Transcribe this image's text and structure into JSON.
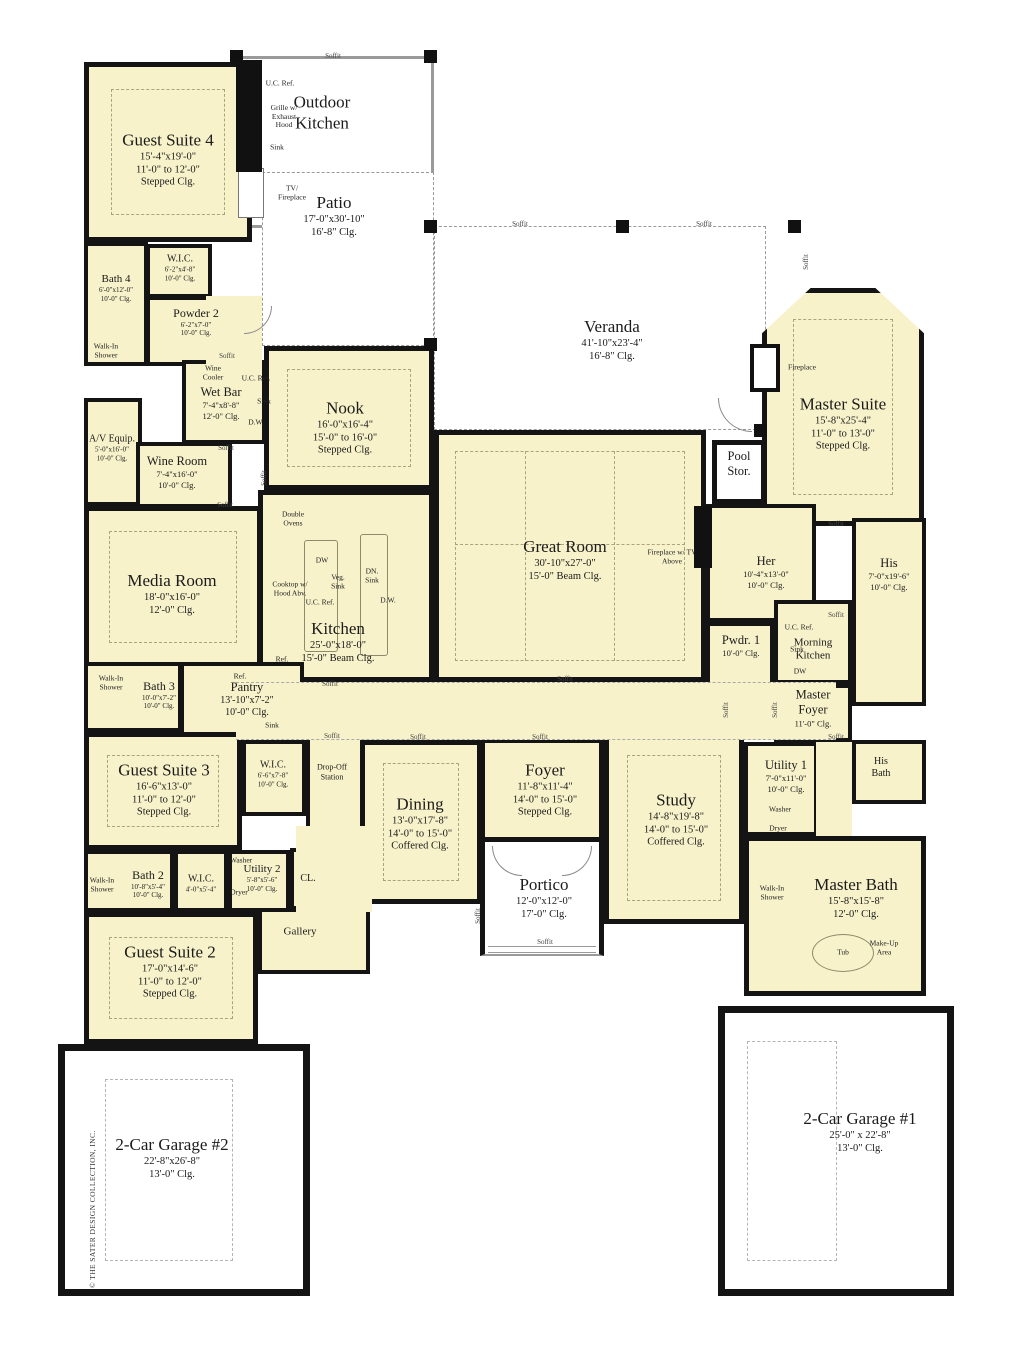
{
  "copyright": "© THE SATER DESIGN COLLECTION, INC.",
  "colors": {
    "room_fill": "#F7F2CA",
    "wall": "#141414",
    "outdoor": "#FFFFFF"
  },
  "rooms": {
    "guest_suite_4": {
      "name": "Guest Suite 4",
      "dim": "15'-4\"x19'-0\"",
      "clg1": "11'-0\" to 12'-0\"",
      "clg2": "Stepped Clg."
    },
    "bath_4": {
      "name": "Bath 4",
      "dim": "6'-0\"x12'-0\"",
      "clg1": "10'-0\" Clg."
    },
    "wic_guest_4": {
      "name": "W.I.C.",
      "dim": "6'-2\"x4'-8\"",
      "clg1": "10'-0\" Clg."
    },
    "powder_2": {
      "name": "Powder 2",
      "dim": "6'-2\"x7'-0\"",
      "clg1": "10'-0\" Clg."
    },
    "outdoor_kitchen": {
      "name": "Outdoor Kitchen"
    },
    "patio": {
      "name": "Patio",
      "dim": "17'-0\"x30'-10\"",
      "clg1": "16'-8\" Clg."
    },
    "veranda": {
      "name": "Veranda",
      "dim": "41'-10\"x23'-4\"",
      "clg1": "16'-8\" Clg."
    },
    "master_suite": {
      "name": "Master Suite",
      "dim": "15'-8\"x25'-4\"",
      "clg1": "11'-0\" to 13'-0\"",
      "clg2": "Stepped Clg."
    },
    "wet_bar": {
      "name": "Wet Bar",
      "dim": "7'-4\"x8'-8\"",
      "clg1": "12'-0\" Clg."
    },
    "av_equip": {
      "name": "A/V Equip.",
      "dim": "5'-0\"x16'-0\"",
      "clg1": "10'-0\" Clg."
    },
    "wine_room": {
      "name": "Wine Room",
      "dim": "7'-4\"x16'-0\"",
      "clg1": "10'-0\" Clg."
    },
    "nook": {
      "name": "Nook",
      "dim": "16'-0\"x16'-4\"",
      "clg1": "15'-0\" to 16'-0\"",
      "clg2": "Stepped Clg."
    },
    "media_room": {
      "name": "Media Room",
      "dim": "18'-0\"x16'-0\"",
      "clg1": "12'-0\" Clg."
    },
    "great_room": {
      "name": "Great Room",
      "dim": "30'-10\"x27'-0\"",
      "clg1": "15'-0\" Beam Clg."
    },
    "kitchen": {
      "name": "Kitchen",
      "dim": "25'-0\"x18'-0\"",
      "clg1": "15'-0\" Beam Clg."
    },
    "pool_stor": {
      "name": "Pool Stor."
    },
    "her": {
      "name": "Her",
      "dim": "10'-4\"x13'-0\"",
      "clg1": "10'-0\" Clg."
    },
    "his": {
      "name": "His",
      "dim": "7'-0\"x19'-6\"",
      "clg1": "10'-0\" Clg."
    },
    "pwdr_1": {
      "name": "Pwdr. 1",
      "clg1": "10'-0\" Clg."
    },
    "morning_kitchen": {
      "name": "Morning Kitchen"
    },
    "master_foyer": {
      "name": "Master Foyer",
      "clg1": "11'-0\" Clg."
    },
    "bath_3": {
      "name": "Bath 3",
      "dim": "10'-0\"x7'-2\"",
      "clg1": "10'-0\" Clg."
    },
    "pantry": {
      "name": "Pantry",
      "dim": "13'-10\"x7'-2\"",
      "clg1": "10'-0\" Clg."
    },
    "guest_suite_3": {
      "name": "Guest Suite 3",
      "dim": "16'-6\"x13'-0\"",
      "clg1": "11'-0\" to 12'-0\"",
      "clg2": "Stepped Clg."
    },
    "wic_guest_3": {
      "name": "W.I.C.",
      "dim": "6'-6\"x7'-8\"",
      "clg1": "10'-0\" Clg."
    },
    "drop_off": {
      "name": "Drop-Off Station"
    },
    "dining": {
      "name": "Dining",
      "dim": "13'-0\"x17'-8\"",
      "clg1": "14'-0\" to 15'-0\"",
      "clg2": "Coffered Clg."
    },
    "foyer": {
      "name": "Foyer",
      "dim": "11'-8\"x11'-4\"",
      "clg1": "14'-0\" to 15'-0\"",
      "clg2": "Stepped Clg."
    },
    "portico": {
      "name": "Portico",
      "dim": "12'-0\"x12'-0\"",
      "clg1": "17'-0\" Clg."
    },
    "study": {
      "name": "Study",
      "dim": "14'-8\"x19'-8\"",
      "clg1": "14'-0\" to 15'-0\"",
      "clg2": "Coffered Clg."
    },
    "utility_1": {
      "name": "Utility 1",
      "dim": "7'-0\"x11'-0\"",
      "clg1": "10'-0\" Clg."
    },
    "his_bath": {
      "name": "His Bath"
    },
    "master_bath": {
      "name": "Master Bath",
      "dim": "15'-8\"x15'-8\"",
      "clg1": "12'-0\" Clg."
    },
    "bath_2": {
      "name": "Bath 2",
      "dim": "10'-8\"x5'-4\"",
      "clg1": "10'-0\" Clg."
    },
    "wic_2": {
      "name": "W.I.C.",
      "dim": "4'-0\"x5'-4\""
    },
    "utility_2": {
      "name": "Utility 2",
      "dim": "5'-8\"x5'-6\"",
      "clg1": "10'-0\" Clg."
    },
    "cl": {
      "name": "CL."
    },
    "gallery": {
      "name": "Gallery"
    },
    "guest_suite_2": {
      "name": "Guest Suite 2",
      "dim": "17'-0\"x14'-6\"",
      "clg1": "11'-0\" to 12'-0\"",
      "clg2": "Stepped Clg."
    },
    "garage_2": {
      "name": "2-Car Garage #2",
      "dim": "22'-8\"x26'-8\"",
      "clg1": "13'-0\" Clg."
    },
    "garage_1": {
      "name": "2-Car Garage #1",
      "dim": "25'-0\" x 22'-8\"",
      "clg1": "13'-0\" Clg."
    }
  },
  "fixtures": {
    "uc_ref": "U.C. Ref.",
    "grille": "Grille w/ Exhaust Hood",
    "sink": "Sink",
    "tv_fireplace": "TV/ Fireplace",
    "wine_cooler": "Wine Cooler",
    "dw_dots": "D.W.",
    "dw": "DW",
    "double_ovens": "Double Ovens",
    "cooktop": "Cooktop w/ Hood Abv.",
    "veg_sink": "Veg. Sink",
    "dn_sink": "DN. Sink",
    "ref": "Ref.",
    "washer": "Washer",
    "dryer": "Dryer",
    "fireplace": "Fireplace",
    "fireplace_tv": "Fireplace w/ TV Above",
    "walk_in_shower": "Walk-In Shower",
    "tub": "Tub",
    "make_up": "Make-Up Area",
    "soffit": "Soffit"
  }
}
